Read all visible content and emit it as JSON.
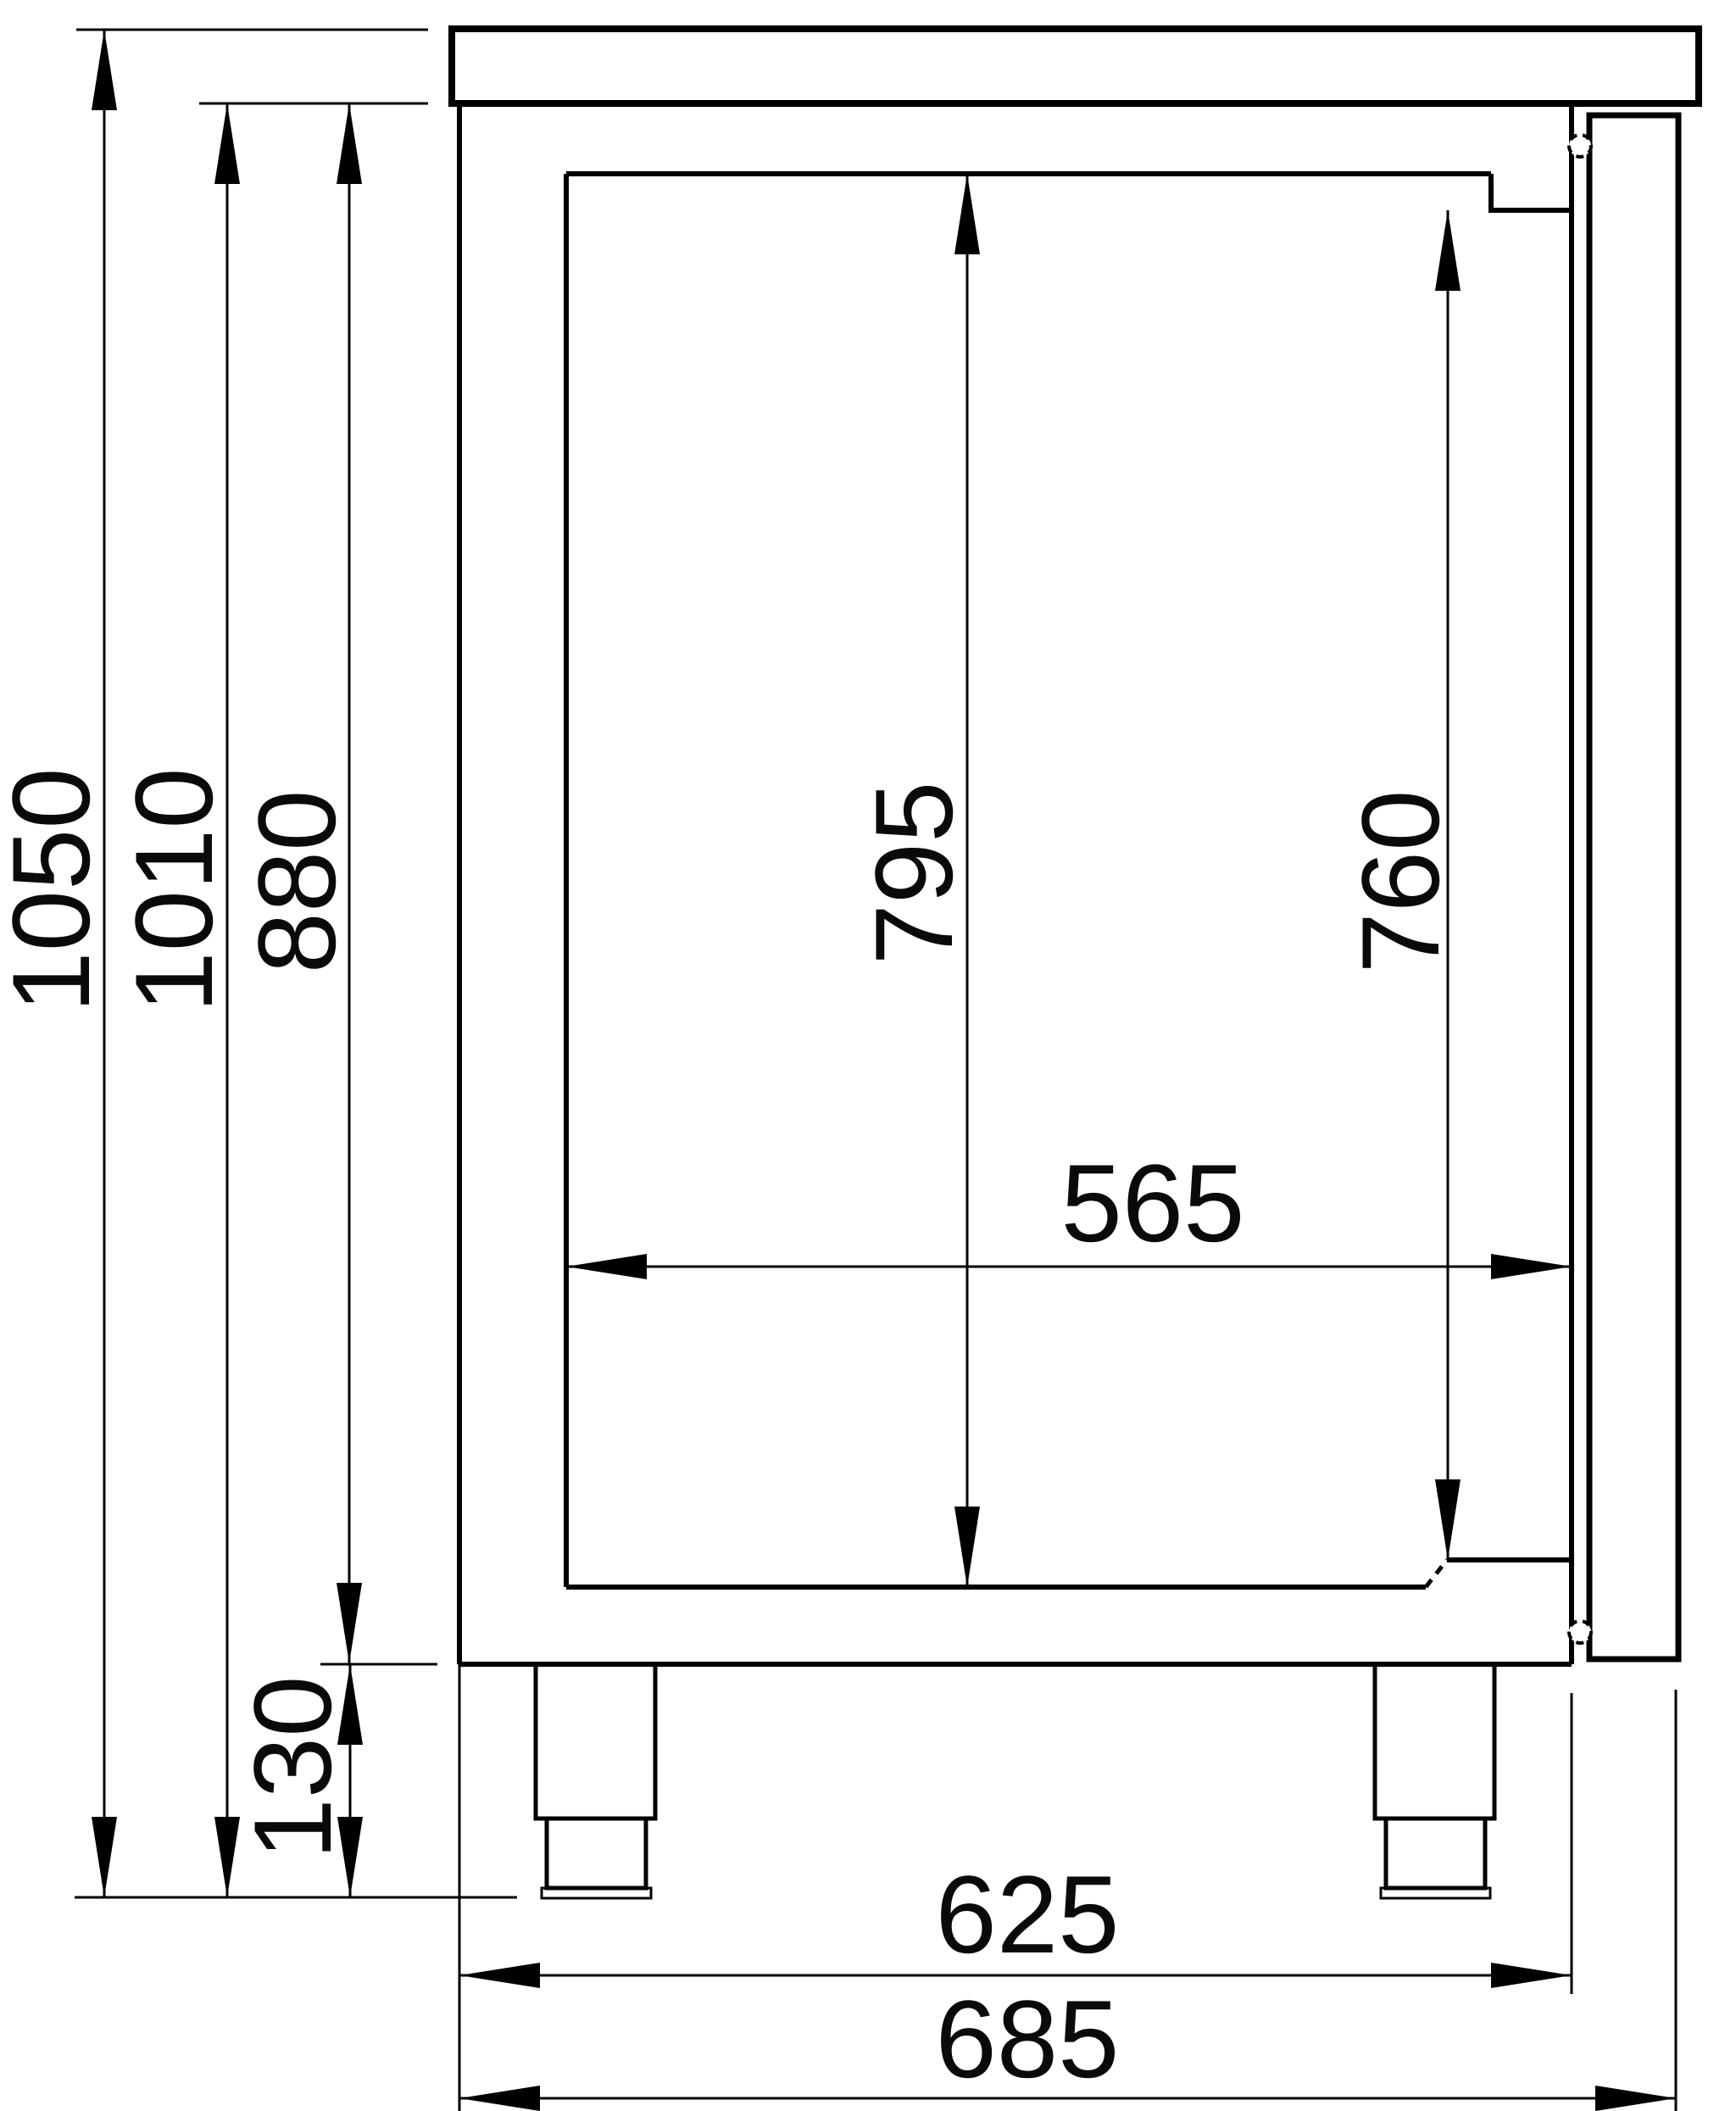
{
  "drawing": {
    "title": "refrigerated-counter-side-view",
    "unit": "mm",
    "dimensions": {
      "overall_height": "1050",
      "height_under_top": "1010",
      "body_height": "880",
      "foot_height": "130",
      "inner_front_height": "795",
      "inner_rear_height": "760",
      "inner_depth": "565",
      "body_depth": "625",
      "overall_depth": "685"
    }
  }
}
